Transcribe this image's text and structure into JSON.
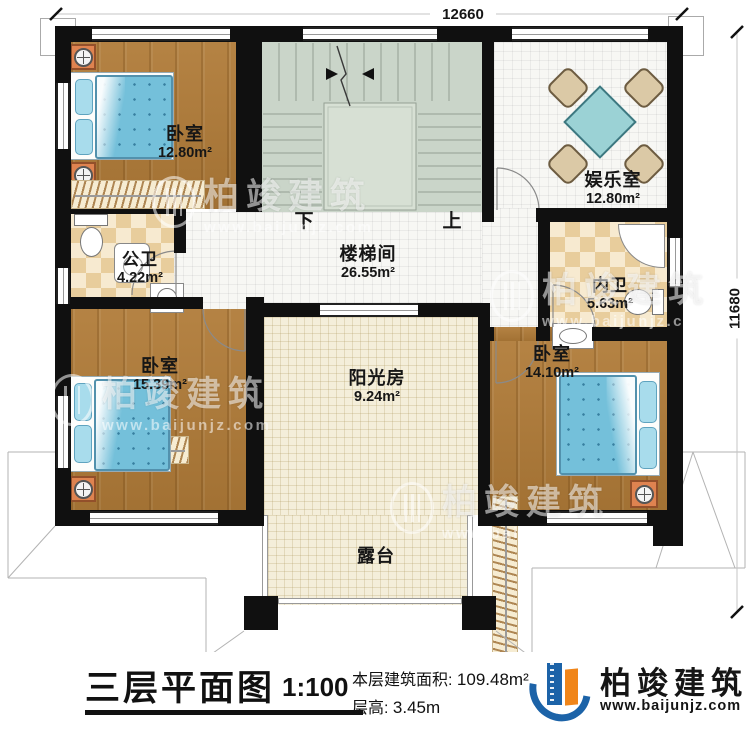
{
  "title_block": {
    "plan_title": "三层平面图",
    "scale": "1:100",
    "area_label": "本层建筑面积:",
    "area_value": "109.48m²",
    "floor_height_label": "层高:",
    "floor_height_value": "3.45m"
  },
  "brand": {
    "name": "柏竣建筑",
    "website": "www.baijunjz.com"
  },
  "watermark": {
    "text": "柏竣建筑",
    "website": "www.baijunjz.com"
  },
  "dimensions": {
    "top": "12660",
    "right": "11680"
  },
  "stairs": {
    "down": "下",
    "up": "上"
  },
  "rooms": [
    {
      "id": "bedroom-1",
      "name": "卧室",
      "area": "12.80m²"
    },
    {
      "id": "entertainment",
      "name": "娱乐室",
      "area": "12.80m²"
    },
    {
      "id": "public-bath",
      "name": "公卫",
      "area": "4.22m²"
    },
    {
      "id": "stairwell",
      "name": "楼梯间",
      "area": "26.55m²"
    },
    {
      "id": "private-bath",
      "name": "内卫",
      "area": "5.63m²"
    },
    {
      "id": "bedroom-2",
      "name": "卧室",
      "area": "15.39m²"
    },
    {
      "id": "bedroom-3",
      "name": "卧室",
      "area": "14.10m²"
    },
    {
      "id": "sunroom",
      "name": "阳光房",
      "area": "9.24m²"
    },
    {
      "id": "terrace",
      "name": "露台",
      "area": ""
    }
  ],
  "colors": {
    "wall": "#101010",
    "wood_floor": "#b07b38",
    "bath_tile_a": "#e8cd9c",
    "bath_tile_b": "#f7ead0",
    "stair_floor": "#cad5c9",
    "bed_blue": "#74c0da",
    "brand_blue": "#1c63a8",
    "brand_orange": "#f08519"
  }
}
